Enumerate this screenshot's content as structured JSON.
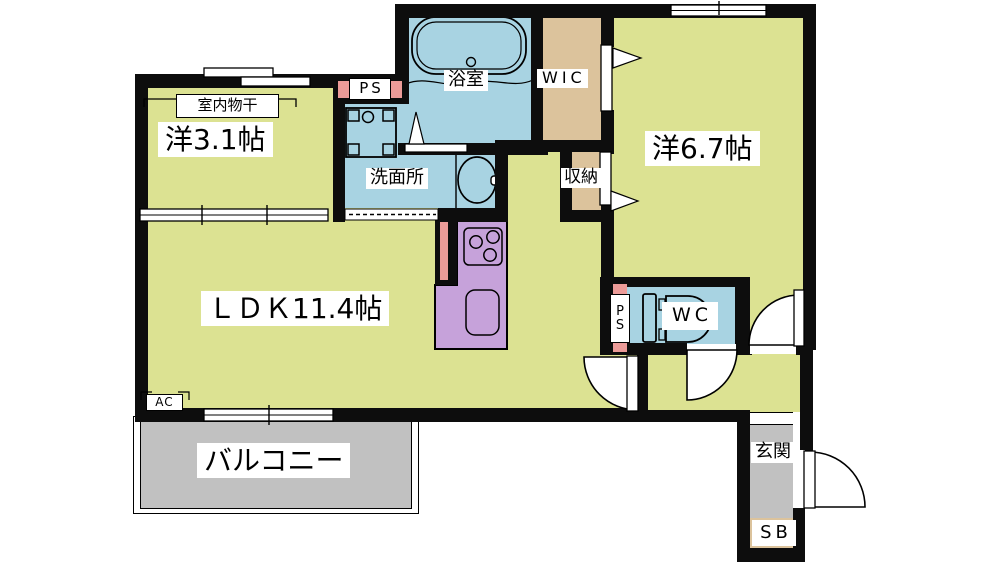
{
  "title": "1LDK apartment floor plan",
  "colors": {
    "room_yellow": "#dce292",
    "water_blue": "#a8d3e2",
    "closet_tan": "#dcc39c",
    "kitchen_purple": "#c6a2da",
    "balcony_gray": "#c1c1c1",
    "ps_pink": "#ec9b98",
    "wall_black": "#0d0d0d"
  },
  "labels": {
    "bedroom1": "洋3.1帖",
    "indoor_drying": "室内物干",
    "ps_top": "PS",
    "bathroom": "浴室",
    "wic": "WIC",
    "bedroom2": "洋6.7帖",
    "washroom": "洗面所",
    "closet": "収納",
    "ldk_prefix": "ＬＤＫ",
    "ldk_size": "11.4帖",
    "wc": "WC",
    "ps_wc_p": "P",
    "ps_wc_s": "S",
    "balcony": "バルコニー",
    "entrance": "玄関",
    "shoe_box": "SB",
    "ac": "AC"
  }
}
